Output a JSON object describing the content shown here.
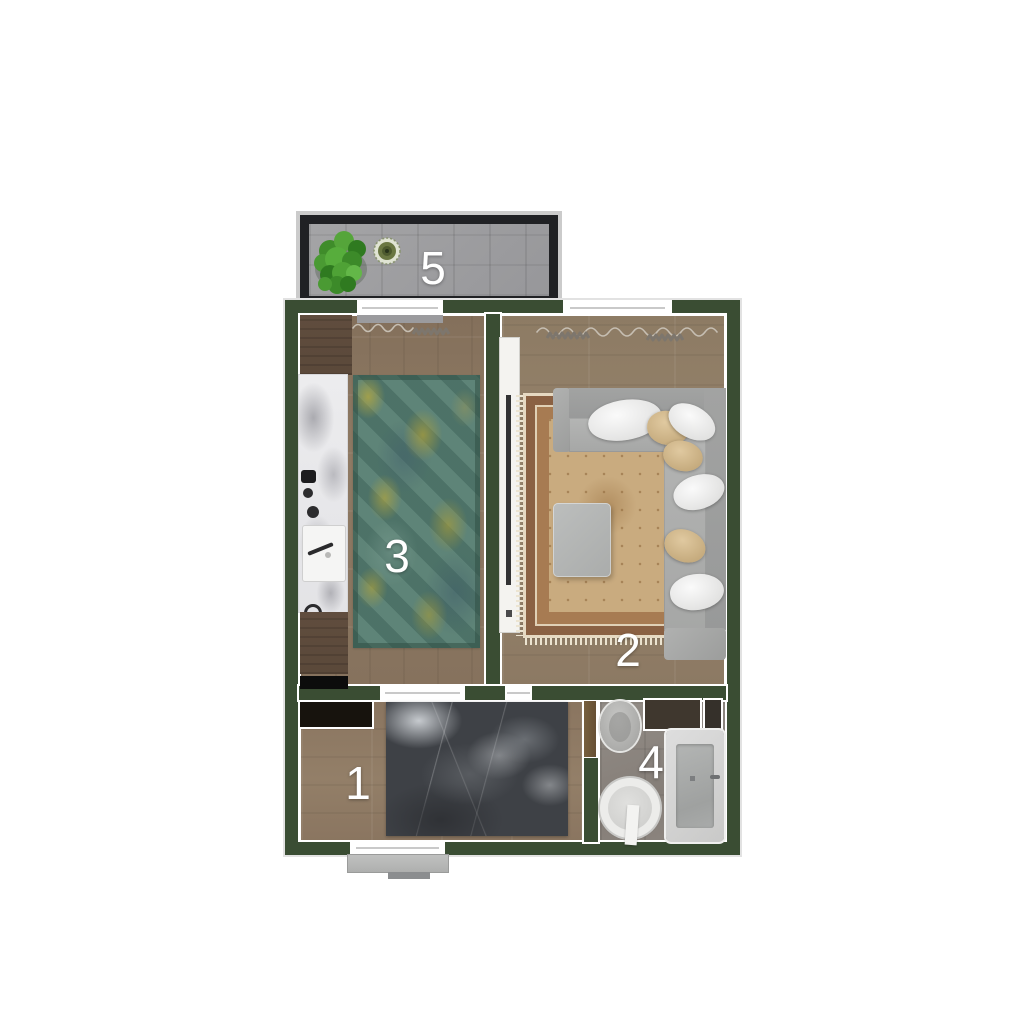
{
  "title": "apartment-floor-plan",
  "rooms": [
    {
      "number": "1",
      "name": "bedroom"
    },
    {
      "number": "2",
      "name": "living-room"
    },
    {
      "number": "3",
      "name": "kitchen"
    },
    {
      "number": "4",
      "name": "bathroom"
    },
    {
      "number": "5",
      "name": "balcony"
    }
  ],
  "palette": {
    "background": "#ffffff",
    "wall_green": "#3a4d33",
    "wall_outline": "#ffffff",
    "balcony_frame": "#202124",
    "balcony_floor": "#9b9b9e",
    "wood_floor_kitchen": "#8a7660",
    "wood_floor_living": "#93806a",
    "wood_floor_bedroom": "#8d7862",
    "bathroom_tile": "#8c8680",
    "kitchen_rug_teal": "#557c70",
    "kitchen_rug_yellow": "#b2a43c",
    "living_rug_border": "#8a6143",
    "living_rug_field": "#c9ab7f",
    "sofa_gray": "#ababaa",
    "pillow_white": "#f2f2f2",
    "pillow_tan": "#d5bc92",
    "coffee_table": "#b3b5b4",
    "bed_dark": "#3e4146",
    "marble_counter": "#e9e9eb",
    "plant_green": "#4a9a33",
    "room_label": "#ffffff"
  }
}
